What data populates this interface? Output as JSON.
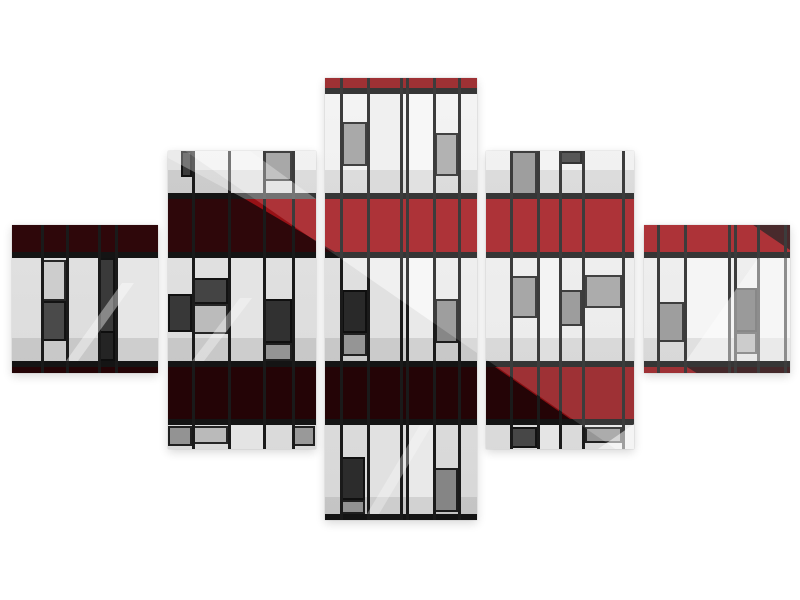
{
  "meta": {
    "description": "Five-part staggered canvas wall-art set showing a modern building facade in Mondrian style: bright red and dark maroon spandrel bands, light grey cladding panels, dark inset windows and black mullions, with diagonal light reflections, on a plain white background."
  },
  "page": {
    "background": "#ffffff"
  },
  "panels": [
    {
      "id": 1,
      "x": 12,
      "y": 225,
      "w": 146,
      "h": 148
    },
    {
      "id": 2,
      "x": 168,
      "y": 151,
      "w": 148,
      "h": 298
    },
    {
      "id": 3,
      "x": 325,
      "y": 78,
      "w": 152,
      "h": 442
    },
    {
      "id": 4,
      "x": 486,
      "y": 151,
      "w": 148,
      "h": 298
    },
    {
      "id": 5,
      "x": 644,
      "y": 225,
      "w": 146,
      "h": 148
    }
  ],
  "artwork": {
    "bounds": {
      "x": 12,
      "y": 78,
      "w": 778,
      "h": 442
    },
    "bar_h": 6,
    "mullion_w": 3,
    "colors": {
      "facade_top": "#f2f2f2",
      "facade_bottom": "#e3e3e3",
      "bar": "#161616",
      "mullion": "#1c1c1c",
      "red_bright": "#a01218",
      "red_dark": "#31080b",
      "red_deep": "#260507",
      "red_strip": "#8f1013"
    },
    "light_columns": [
      {
        "x": 115,
        "w": 43,
        "color": "#f3f3f3"
      },
      {
        "x": 228,
        "w": 35,
        "color": "#f1f1f1"
      },
      {
        "x": 367,
        "w": 33,
        "color": "#eeeeee"
      },
      {
        "x": 406,
        "w": 27,
        "color": "#f6f6f6"
      },
      {
        "x": 537,
        "w": 22,
        "color": "#f2f2f2"
      },
      {
        "x": 684,
        "w": 44,
        "color": "#f4f4f4"
      },
      {
        "x": 757,
        "w": 29,
        "color": "#ededed"
      }
    ],
    "shade_strips": [
      {
        "y": 170,
        "h": 23,
        "color": "rgba(130,130,130,0.22)"
      },
      {
        "y": 338,
        "h": 23,
        "color": "rgba(130,130,130,0.22)"
      },
      {
        "y": 497,
        "h": 17,
        "color": "rgba(130,130,130,0.20)"
      }
    ],
    "bands": [
      {
        "name": "red-strip-top",
        "y": 78,
        "h": 10,
        "color": "#8f1013",
        "overlays": []
      },
      {
        "name": "red-band-upper",
        "y": 199,
        "h": 53,
        "color": "#a01218",
        "overlays": [
          {
            "points": "12,199 245,199 335,252 12,252",
            "color": "#31080b"
          },
          {
            "points": "715,199 790,199 790,250",
            "color": "#2c070a"
          }
        ]
      },
      {
        "name": "red-band-lower",
        "y": 367,
        "h": 52,
        "color": "#260507",
        "overlays": [
          {
            "points": "495,367 687,367 770,419 570,419",
            "color": "#8f1014"
          }
        ]
      }
    ],
    "bars": [
      88,
      193,
      252,
      361,
      419,
      514
    ],
    "mullions": [
      41,
      66,
      98,
      115,
      192,
      228,
      263,
      292,
      340,
      367,
      400,
      406,
      433,
      458,
      510,
      537,
      559,
      582,
      622,
      657,
      684,
      728,
      734,
      757,
      784
    ],
    "windows": [
      {
        "x": 181,
        "y": 151,
        "w": 11,
        "h": 26,
        "color": "#3f3f3f"
      },
      {
        "x": 263,
        "y": 151,
        "w": 29,
        "h": 30,
        "color": "#9a9a9a"
      },
      {
        "x": 342,
        "y": 122,
        "w": 25,
        "h": 44,
        "color": "#9b9b9b"
      },
      {
        "x": 435,
        "y": 133,
        "w": 23,
        "h": 43,
        "color": "#a6a6a6"
      },
      {
        "x": 510,
        "y": 151,
        "w": 27,
        "h": 44,
        "color": "#8f8f8f"
      },
      {
        "x": 559,
        "y": 151,
        "w": 23,
        "h": 13,
        "color": "#3c3c3c"
      },
      {
        "x": 41,
        "y": 260,
        "w": 25,
        "h": 41,
        "color": "#d8d8d8"
      },
      {
        "x": 41,
        "y": 301,
        "w": 25,
        "h": 40,
        "color": "#4e4e4e"
      },
      {
        "x": 98,
        "y": 258,
        "w": 17,
        "h": 103,
        "color": "#3e3e3e"
      },
      {
        "x": 98,
        "y": 331,
        "w": 17,
        "h": 30,
        "color": "#262626"
      },
      {
        "x": 168,
        "y": 294,
        "w": 24,
        "h": 38,
        "color": "#3b3b3b"
      },
      {
        "x": 192,
        "y": 278,
        "w": 36,
        "h": 26,
        "color": "#484848"
      },
      {
        "x": 192,
        "y": 304,
        "w": 36,
        "h": 30,
        "color": "#c6c6c6"
      },
      {
        "x": 263,
        "y": 299,
        "w": 29,
        "h": 44,
        "color": "#343434"
      },
      {
        "x": 263,
        "y": 343,
        "w": 29,
        "h": 18,
        "color": "#9c9c9c"
      },
      {
        "x": 342,
        "y": 290,
        "w": 25,
        "h": 43,
        "color": "#2c2c2c"
      },
      {
        "x": 342,
        "y": 333,
        "w": 25,
        "h": 23,
        "color": "#9e9e9e"
      },
      {
        "x": 435,
        "y": 299,
        "w": 23,
        "h": 44,
        "color": "#8f8f8f"
      },
      {
        "x": 510,
        "y": 276,
        "w": 27,
        "h": 42,
        "color": "#999999"
      },
      {
        "x": 559,
        "y": 290,
        "w": 23,
        "h": 36,
        "color": "#8d8d8d"
      },
      {
        "x": 585,
        "y": 275,
        "w": 37,
        "h": 33,
        "color": "#9f9f9f"
      },
      {
        "x": 657,
        "y": 302,
        "w": 27,
        "h": 40,
        "color": "#8f8f8f"
      },
      {
        "x": 734,
        "y": 288,
        "w": 23,
        "h": 44,
        "color": "#353535"
      },
      {
        "x": 734,
        "y": 332,
        "w": 23,
        "h": 22,
        "color": "#9a9a9a"
      },
      {
        "x": 168,
        "y": 426,
        "w": 24,
        "h": 20,
        "color": "#9b9b9b"
      },
      {
        "x": 192,
        "y": 426,
        "w": 36,
        "h": 18,
        "color": "#c4c4c4"
      },
      {
        "x": 292,
        "y": 426,
        "w": 23,
        "h": 20,
        "color": "#a2a2a2"
      },
      {
        "x": 341,
        "y": 457,
        "w": 24,
        "h": 43,
        "color": "#2f2f2f"
      },
      {
        "x": 341,
        "y": 500,
        "w": 24,
        "h": 14,
        "color": "#9a9a9a"
      },
      {
        "x": 433,
        "y": 468,
        "w": 25,
        "h": 44,
        "color": "#8d8d8d"
      },
      {
        "x": 510,
        "y": 427,
        "w": 27,
        "h": 21,
        "color": "#4b4b4b"
      },
      {
        "x": 585,
        "y": 427,
        "w": 37,
        "h": 16,
        "color": "#9f9f9f"
      }
    ],
    "highlights": [
      {
        "points": "80,78 790,78 790,520 718,520",
        "color": "rgba(255,255,255,0.14)"
      },
      {
        "points": "12,78 80,78 718,520 12,520",
        "color": "rgba(0,0,0,0.05)"
      },
      {
        "points": "758,258 790,258 790,361 686,361",
        "color": "rgba(255,255,255,0.42)"
      },
      {
        "points": "598,449 634,424 634,449",
        "color": "rgba(255,255,255,0.5)"
      },
      {
        "points": "66,361 122,283 134,283 78,361",
        "color": "rgba(255,255,255,0.40)"
      },
      {
        "points": "192,361 240,298 252,298 204,361",
        "color": "rgba(255,255,255,0.35)"
      },
      {
        "points": "367,514 420,425 432,425 379,514",
        "color": "rgba(255,255,255,0.30)"
      },
      {
        "points": "168,151 250,151 316,199 245,199 168,158",
        "color": "rgba(255,255,255,0.30)"
      }
    ]
  }
}
